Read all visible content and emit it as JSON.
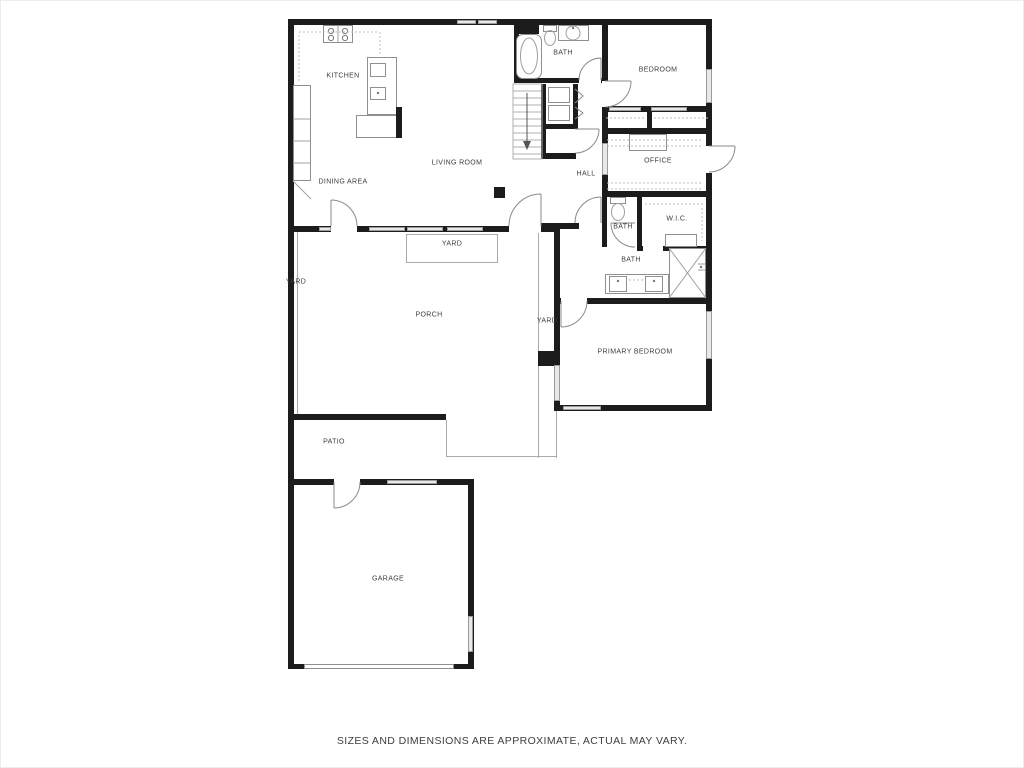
{
  "rooms": {
    "kitchen": {
      "label": "KITCHEN"
    },
    "dining": {
      "label": "DINING AREA"
    },
    "living": {
      "label": "LIVING ROOM"
    },
    "bath_top": {
      "label": "BATH"
    },
    "bedroom": {
      "label": "BEDROOM"
    },
    "office": {
      "label": "OFFICE"
    },
    "hall": {
      "label": "HALL"
    },
    "bath_small": {
      "label": "BATH"
    },
    "wic": {
      "label": "W.I.C."
    },
    "bath_primary": {
      "label": "BATH"
    },
    "primary_bedroom": {
      "label": "PRIMARY BEDROOM"
    },
    "porch": {
      "label": "PORCH"
    },
    "patio": {
      "label": "PATIO"
    },
    "garage": {
      "label": "GARAGE"
    },
    "yard_top": {
      "label": "YARD"
    },
    "yard_left": {
      "label": "YARD"
    },
    "yard_mid": {
      "label": "YARD"
    }
  },
  "footer": {
    "disclaimer": "SIZES AND DIMENSIONS ARE APPROXIMATE, ACTUAL MAY VARY."
  },
  "colors": {
    "wall": "#1c1c1c",
    "thin_line": "#aaaaaa",
    "window_fill": "#e8e8e8",
    "label_text": "#3d3d3d"
  }
}
